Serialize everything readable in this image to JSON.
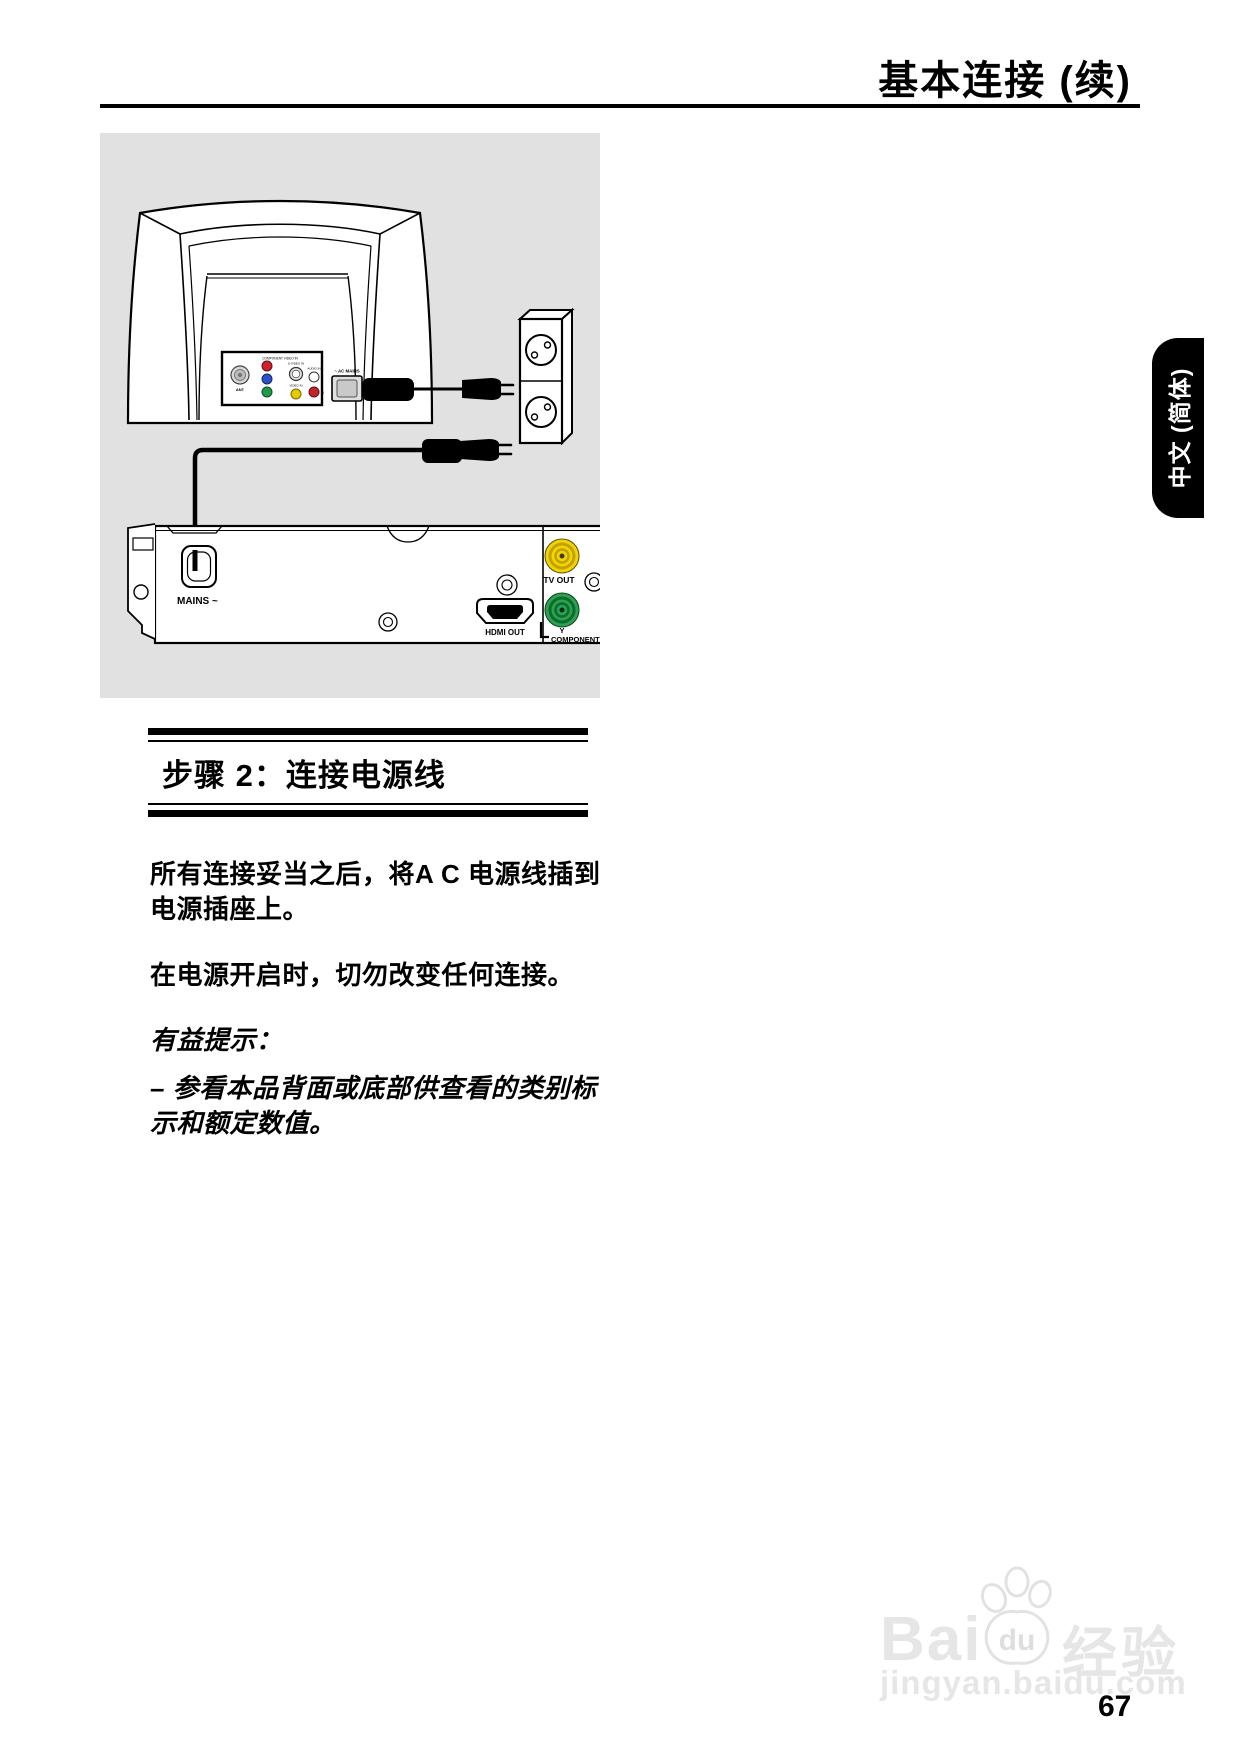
{
  "header": {
    "title": "基本连接 (续)"
  },
  "language_tab": {
    "label": "中文 (简体)"
  },
  "diagram": {
    "labels": {
      "tv_panel_heading": "COMPONENT VIDEO IN",
      "ant": "ANT",
      "s_video_in": "S-VIDEO IN",
      "video_in": "VIDEO IN",
      "audio_in": "AUDIO IN",
      "audio_l": "L",
      "audio_r": "R",
      "ac_mains": "~ AC MAINS",
      "mains": "MAINS ~",
      "hdmi_out": "HDMI OUT",
      "tv_out": "TV OUT",
      "component_y": "Y",
      "component": "COMPONENT"
    },
    "colors": {
      "box_background": "#e1e1e1",
      "jack_yellow": "#f4d304",
      "jack_green": "#2aa24f",
      "rca_red": "#cc2229",
      "rca_blue": "#2953c6",
      "rca_green": "#1f9a48"
    }
  },
  "section": {
    "heading": "步骤 2：连接电源线"
  },
  "body": {
    "paragraph1_line1": "所有连接妥当之后，将A C 电源线插到",
    "paragraph1_line2": "电源插座上。",
    "paragraph2": "在电源开启时，切勿改变任何连接。",
    "hint_title": "有益提示：",
    "hint_line1": "– 参看本品背面或底部供查看的类别标",
    "hint_line2": "示和额定数值。"
  },
  "watermark": {
    "brand_latin": "Bai",
    "brand_du": "du",
    "brand_cn": "经验",
    "url": "jingyan.baidu.com"
  },
  "footer": {
    "page_number": "67"
  }
}
